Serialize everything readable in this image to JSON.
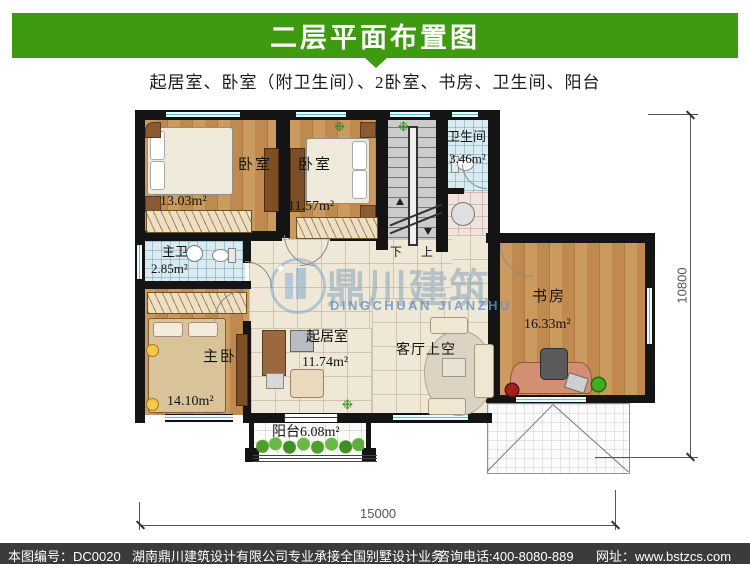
{
  "header": {
    "title": "二层平面布置图",
    "subtitle": "起居室、卧室（附卫生间）、2卧室、书房、卫生间、阳台",
    "banner_color": "#3e9b10"
  },
  "plan": {
    "rooms": [
      {
        "id": "bedroom-1",
        "name": "卧室",
        "area": "13.03m²"
      },
      {
        "id": "bedroom-2",
        "name": "卧室",
        "area": "11.57m²"
      },
      {
        "id": "bathroom",
        "name": "卫生间",
        "area": "3.46m²"
      },
      {
        "id": "master-bath",
        "name": "主卫",
        "area": "2.85m²"
      },
      {
        "id": "master-bedroom",
        "name": "主卧",
        "area": "14.10m²"
      },
      {
        "id": "living-room",
        "name": "起居室",
        "area": "11.74m²"
      },
      {
        "id": "void",
        "name": "客厅上空",
        "area": ""
      },
      {
        "id": "study",
        "name": "书房",
        "area": "16.33m²"
      },
      {
        "id": "balcony",
        "name": "阳台6.08m²",
        "area": ""
      }
    ],
    "stairs": {
      "down": "下",
      "up": "上"
    },
    "dimensions": {
      "width": "15000",
      "height": "10800"
    }
  },
  "watermark": {
    "cn": "鼎川建筑",
    "en": "DINGCHUAN JIANZHU"
  },
  "footer": {
    "bg": "#3b3b3b",
    "drawing_no": "本图编号：DC0020",
    "company": "湖南鼎川建筑设计有限公司专业承接全国别墅设计业务",
    "phone": "咨询电话:400-8080-889",
    "site": "网址：www.bstzcs.com"
  }
}
